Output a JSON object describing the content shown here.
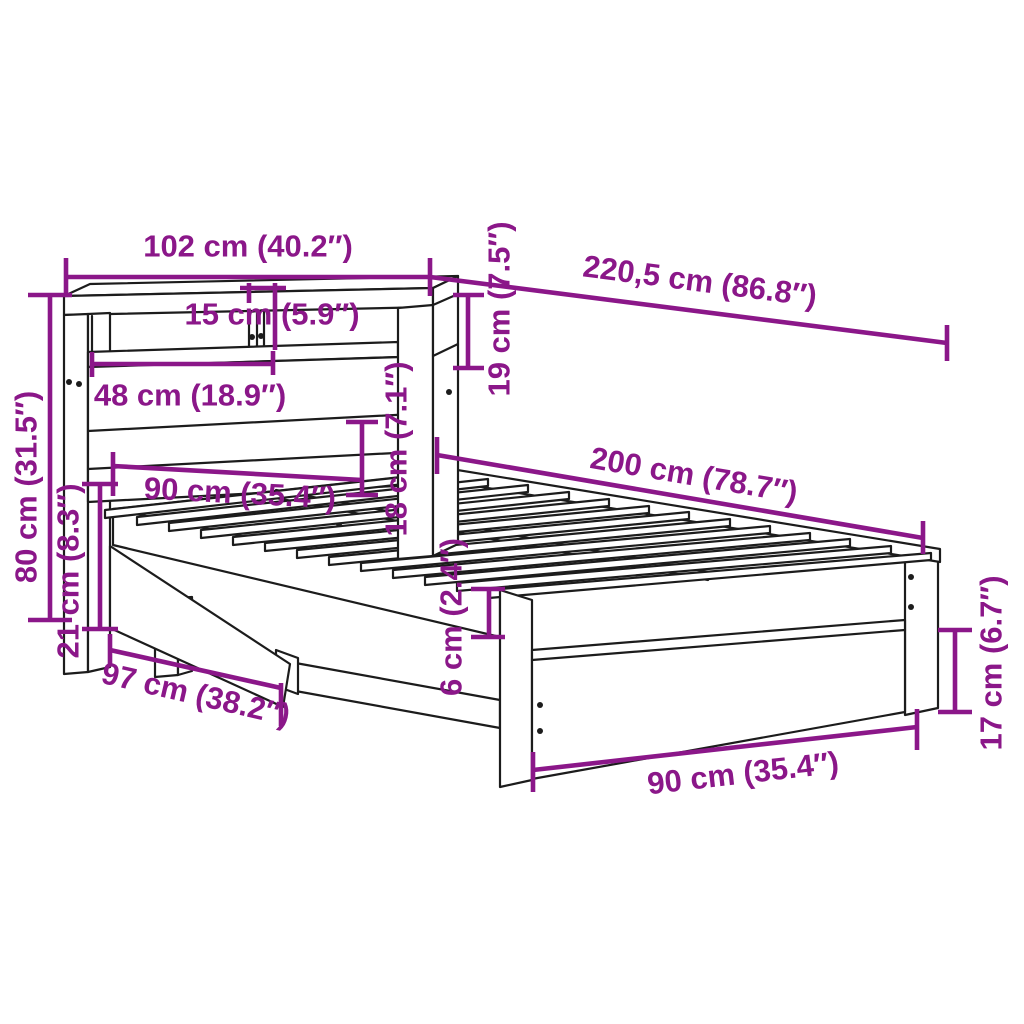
{
  "diagram_title": "bed-frame-with-bookcase-headboard-dimension-diagram",
  "colors": {
    "accent": "#8B1789",
    "line": "#1c1c1c",
    "background": "#ffffff"
  },
  "units": {
    "metric": "cm",
    "imperial": "inches"
  },
  "dimensions": [
    {
      "id": "headboard-width",
      "label": "102 cm (40.2″)",
      "cm": "102",
      "inch": "40.2"
    },
    {
      "id": "total-length",
      "label": "220,5 cm (86.8″)",
      "cm": "220,5",
      "inch": "86.8"
    },
    {
      "id": "shelf-divider-gap",
      "label": "15 cm (5.9″)",
      "cm": "15",
      "inch": "5.9"
    },
    {
      "id": "shelf-height",
      "label": "19 cm (7.5″)",
      "cm": "19",
      "inch": "7.5"
    },
    {
      "id": "compartment-width",
      "label": "48 cm (18.9″)",
      "cm": "48",
      "inch": "18.9"
    },
    {
      "id": "headboard-height",
      "label": "80 cm (31.5″)",
      "cm": "80",
      "inch": "31.5"
    },
    {
      "id": "headboard-leg-height",
      "label": "21 cm (8.3″)",
      "cm": "21",
      "inch": "8.3"
    },
    {
      "id": "bed-width-head",
      "label": "90 cm (35.4″)",
      "cm": "90",
      "inch": "35.4"
    },
    {
      "id": "frame-height",
      "label": "18 cm (7.1″)",
      "cm": "18",
      "inch": "7.1"
    },
    {
      "id": "rail-edge",
      "label": "6 cm (2.4″)",
      "cm": "6",
      "inch": "2.4"
    },
    {
      "id": "side-length",
      "label": "97 cm (38.2″)",
      "cm": "97",
      "inch": "38.2"
    },
    {
      "id": "mattress-length",
      "label": "200 cm (78.7″)",
      "cm": "200",
      "inch": "78.7"
    },
    {
      "id": "foot-leg-height",
      "label": "17 cm (6.7″)",
      "cm": "17",
      "inch": "6.7"
    },
    {
      "id": "bed-width-foot",
      "label": "90 cm (35.4″)",
      "cm": "90",
      "inch": "35.4"
    }
  ]
}
